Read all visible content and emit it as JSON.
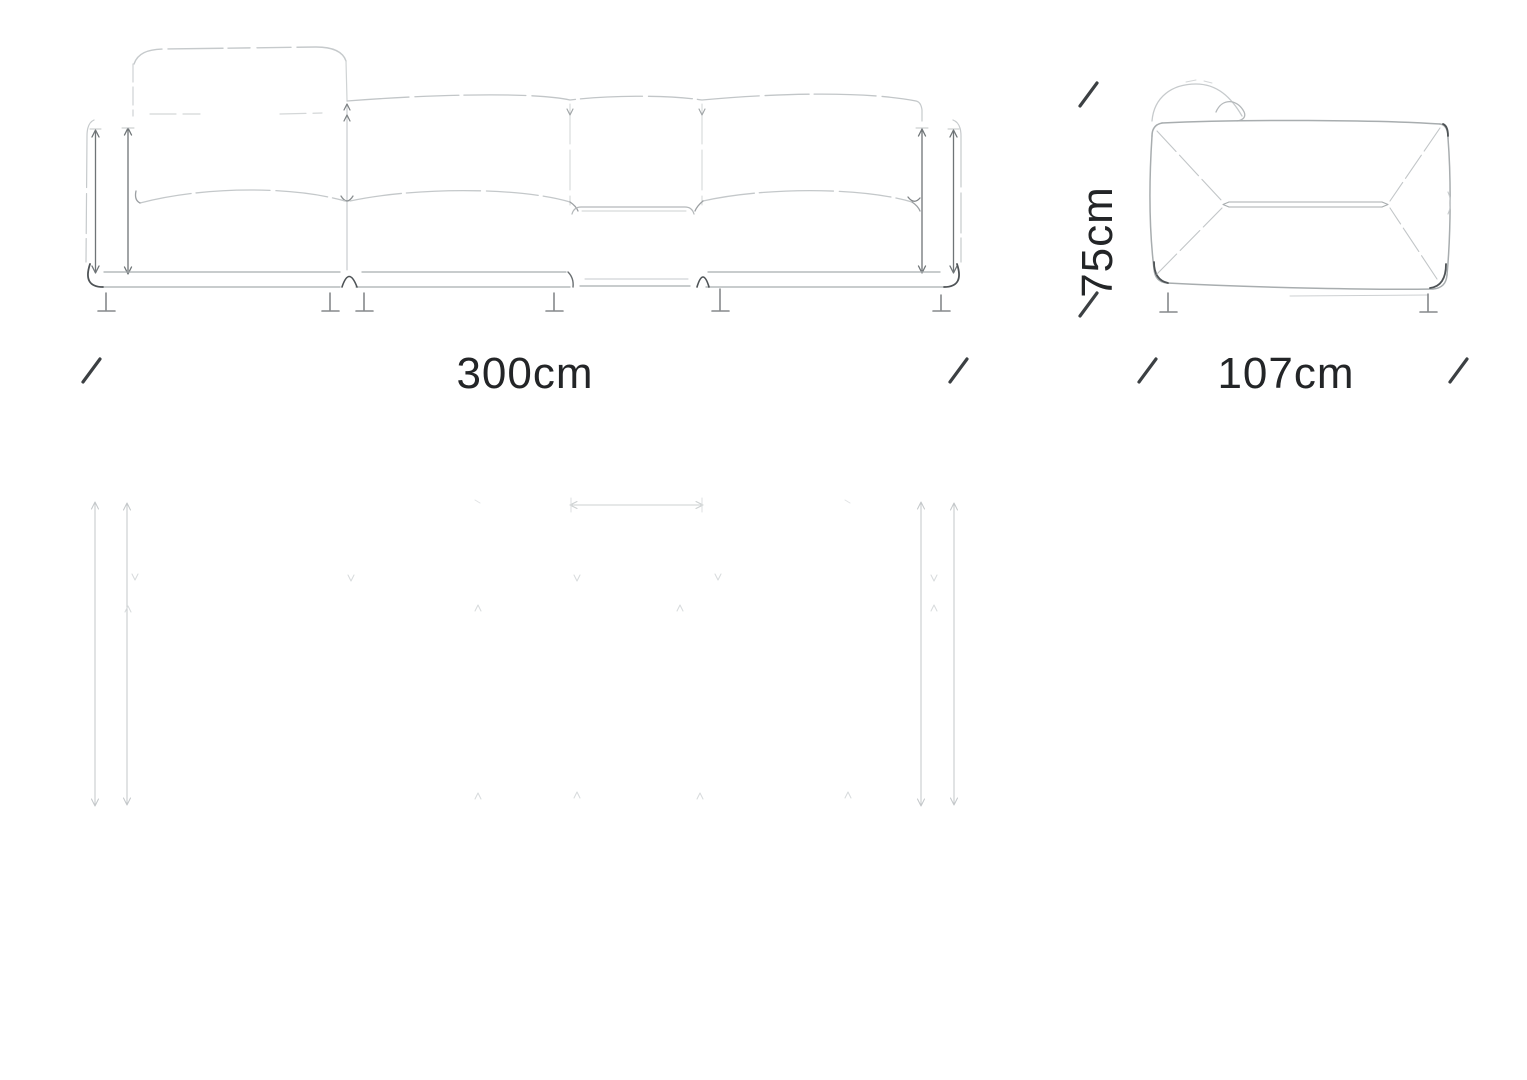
{
  "page": {
    "background_color": "#ffffff",
    "description": "sofa technical dimension drawing"
  },
  "colors": {
    "outline": "#a8adaf",
    "soft_line": "#c6cacc",
    "dark_accent": "#4e5356",
    "leg_line": "#85898b",
    "ghost_line": "#c9cdce",
    "ghost_faint": "#dcdfe0",
    "tick": "#3c4043",
    "text": "#232527"
  },
  "diagram": {
    "type": "sofa-dimension-drawing",
    "views": {
      "front": {
        "title": "front-elevation",
        "width_label": "300cm"
      },
      "side": {
        "title": "side-elevation",
        "height_label": "75cm",
        "depth_label": "107cm"
      },
      "plan": {
        "title": "plan-view-ghost"
      }
    },
    "dimensions_cm": {
      "width": 300,
      "depth": 107,
      "height": 75
    }
  }
}
